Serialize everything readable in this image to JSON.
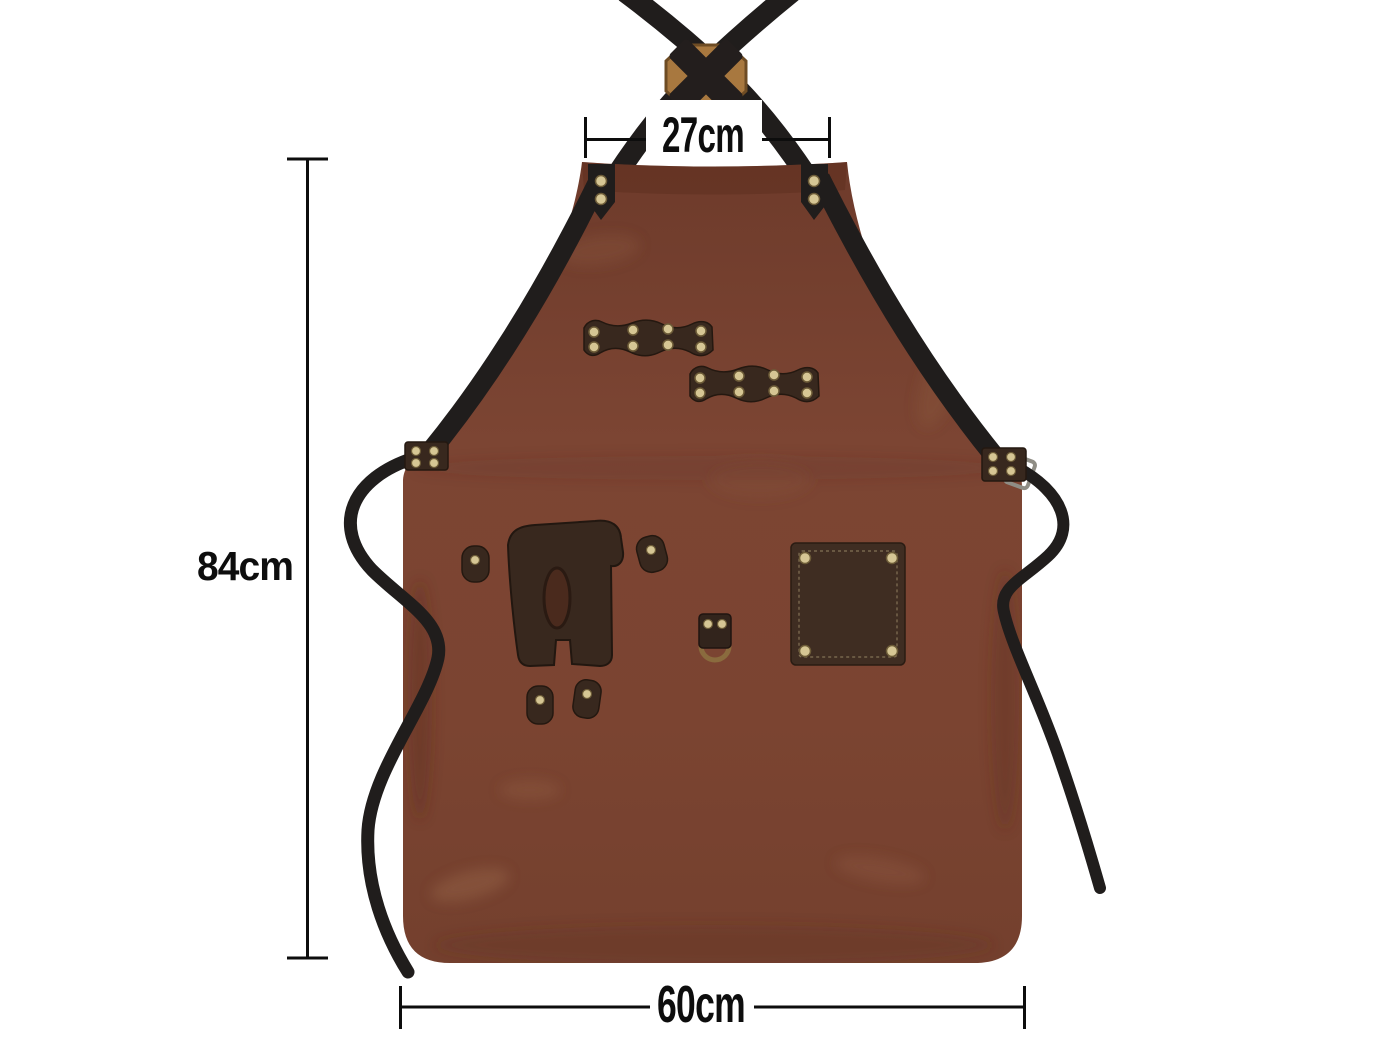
{
  "title": "Leather apron size diagram",
  "dimensions": {
    "neck_width": {
      "label": "27cm"
    },
    "height": {
      "label": "84cm"
    },
    "width": {
      "label": "60cm"
    }
  },
  "product_parts": {
    "apron_body": "leather apron",
    "neck_straps": "crossed black straps",
    "strap_patch": "octagon wood patch with X strap cross",
    "tool_loops": "riveted tool loop strips",
    "holster": "leather tool holster with slot",
    "d_ring": "bronze D-ring holder",
    "pocket": "riveted patch pocket",
    "waist_straps": "side waist straps"
  },
  "colors": {
    "background": "#ffffff",
    "apron-leather": "#7a4331",
    "apron-leather-dark": "#6e3b2b",
    "apron-hem": "#5a2c1c",
    "strap-black": "#201d1c",
    "accessory-leather": "#38281e",
    "pocket-leather": "#3f2d22",
    "rivet-brass": "#d6c694",
    "rivet-edge": "#6d5c38",
    "buckle-wood": "#a8783f",
    "d-ring-bronze": "#8a6b3e",
    "dimension-ink": "#0d0d0d"
  }
}
